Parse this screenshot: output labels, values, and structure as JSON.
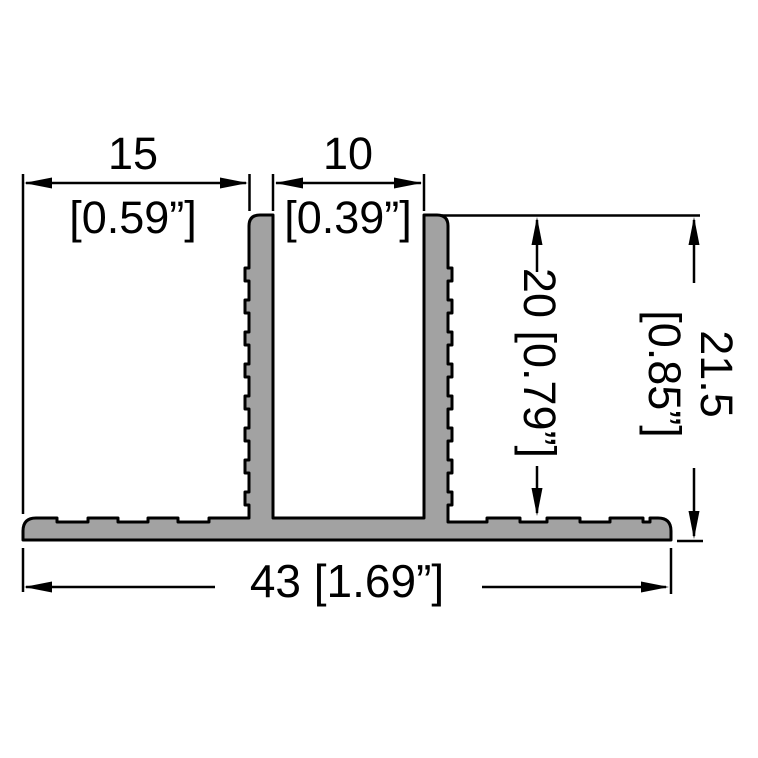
{
  "drawing": {
    "type": "technical-cross-section",
    "background": "#ffffff",
    "profile_fill": "#a2a2a2",
    "outline_color": "#000000",
    "dimensions": {
      "left_opening": {
        "mm": "15",
        "inch": "[0.59”]",
        "orientation": "horizontal"
      },
      "center_opening": {
        "mm": "10",
        "inch": "[0.39”]",
        "orientation": "horizontal"
      },
      "inner_height": {
        "combined": "20 [0.79”]",
        "orientation": "vertical"
      },
      "overall_height": {
        "mm": "21.5",
        "inch": "[0.85”]",
        "orientation": "vertical"
      },
      "overall_width": {
        "combined": "43 [1.69”]",
        "orientation": "horizontal"
      }
    }
  }
}
